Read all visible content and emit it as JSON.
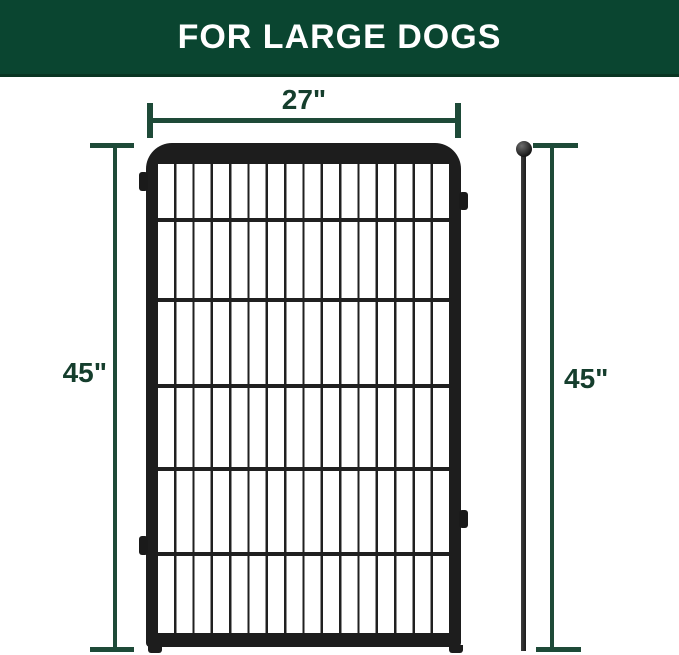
{
  "header": {
    "title": "FOR LARGE DOGS",
    "bg_color": "#0a4530",
    "text_color": "#ffffff"
  },
  "diagram": {
    "width_label": "27\"",
    "left_height_label": "45\"",
    "right_height_label": "45\"",
    "dimension_line_color": "#1e4a38",
    "dimension_text_color": "#153e2d",
    "fence_panel": {
      "frame_color": "#1d1d1d",
      "grid_columns": 16,
      "grid_rows": 6,
      "connector_tabs": 4,
      "feet": 2
    },
    "ground_stake": {
      "color": "#1d1d1d",
      "ball_top": true
    }
  }
}
